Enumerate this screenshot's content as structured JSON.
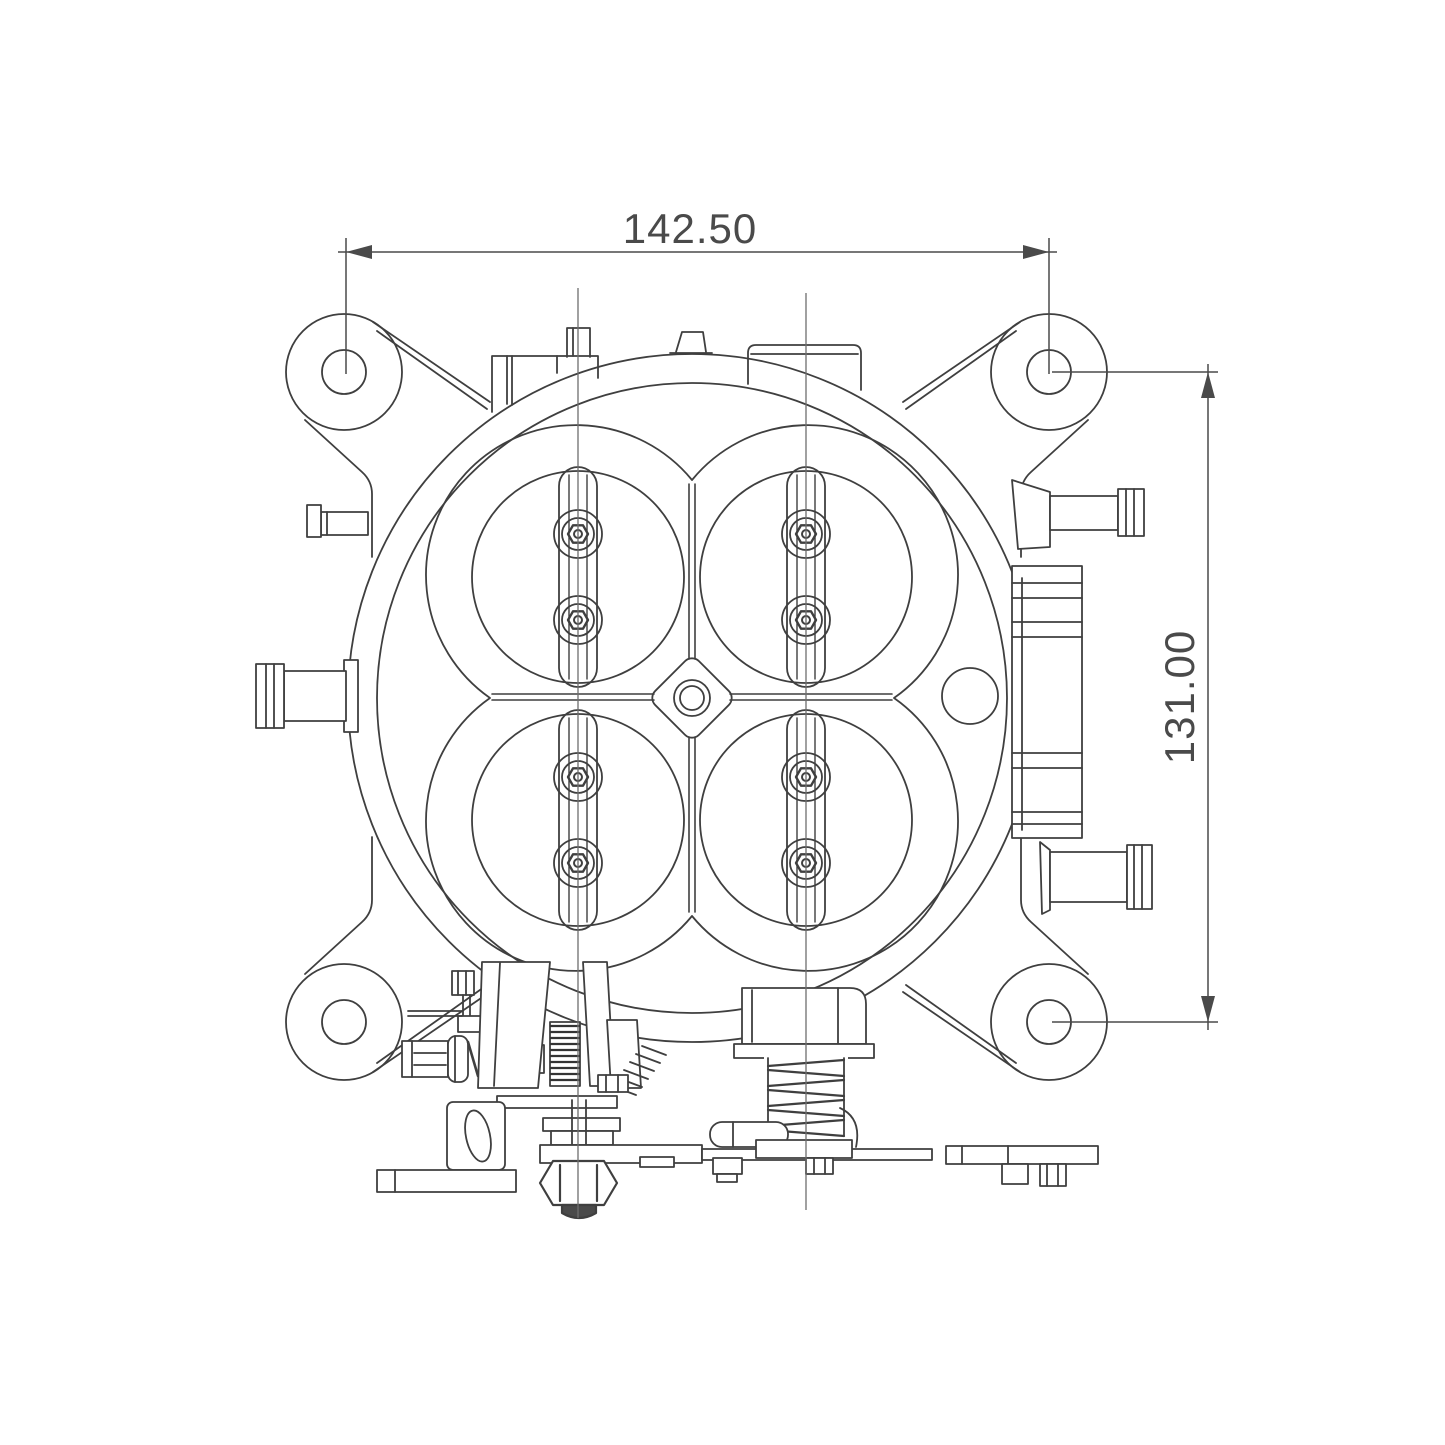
{
  "drawing": {
    "description": "Engineering line drawing, front view of a four-barrel throttle body with throttle plates, shaft screws, four mounting ears, hose barbs, ribbed block and throttle linkage",
    "view": "front",
    "line_color": "#3f3f3f",
    "centerline_color": "#6e6e6e",
    "background_color": "#ffffff",
    "dimensions": {
      "width": {
        "value": "142.50",
        "orientation": "horizontal"
      },
      "height": {
        "value": "131.00",
        "orientation": "vertical"
      }
    }
  }
}
